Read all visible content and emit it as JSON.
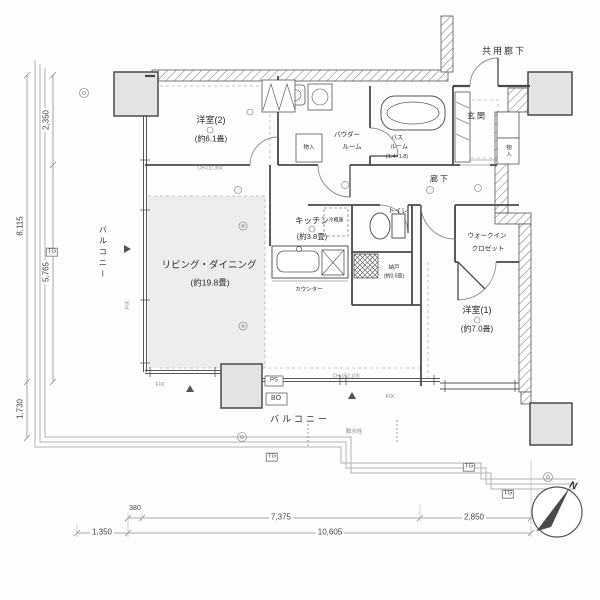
{
  "plan": {
    "rooms": {
      "common_corridor": "共用廊下",
      "bedroom2": {
        "name": "洋室(2)",
        "size": "(約6.1畳)"
      },
      "powder_room": {
        "line1": "パウダー",
        "line2": "ルーム"
      },
      "bathroom": {
        "line1": "バス",
        "line2": "ルーム",
        "size": "(1.4×1.8)"
      },
      "entrance": "玄関",
      "corridor": "廊下",
      "kitchen": {
        "name": "キッチン",
        "size": "(約3.8畳)"
      },
      "toilet": "トイレ",
      "storage": {
        "name": "納戸",
        "size": "(約0.5畳)"
      },
      "living_dining": {
        "name": "リビング・ダイニング",
        "size": "(約19.8畳)"
      },
      "walk_in_closet": {
        "line1": "ウォークイン",
        "line2": "クロゼット"
      },
      "bedroom1": {
        "name": "洋室(1)",
        "size": "(約7.0畳)"
      },
      "balcony_left": "バルコニー",
      "balcony_bottom": "バルコニー"
    },
    "fixtures": {
      "closet1": "物入",
      "closet2": "物入",
      "refrigerator": "冷蔵庫",
      "counter": "カウンター",
      "water_tap": "散水栓"
    },
    "markers": {
      "tg": "TG",
      "ps": "PS",
      "bo": "BO",
      "fix": "FIX",
      "ch1": "CH-D2,350",
      "ch2": "CH-152,105"
    },
    "dimensions": {
      "left_2350": "2,350",
      "left_8115": "8,115",
      "left_5765": "5,765",
      "left_1730": "1,730",
      "bottom_1350": "1,350",
      "bottom_380": "380",
      "bottom_7375": "7,375",
      "bottom_2850": "2,850",
      "bottom_10605": "10,605"
    },
    "compass_north": "N"
  }
}
